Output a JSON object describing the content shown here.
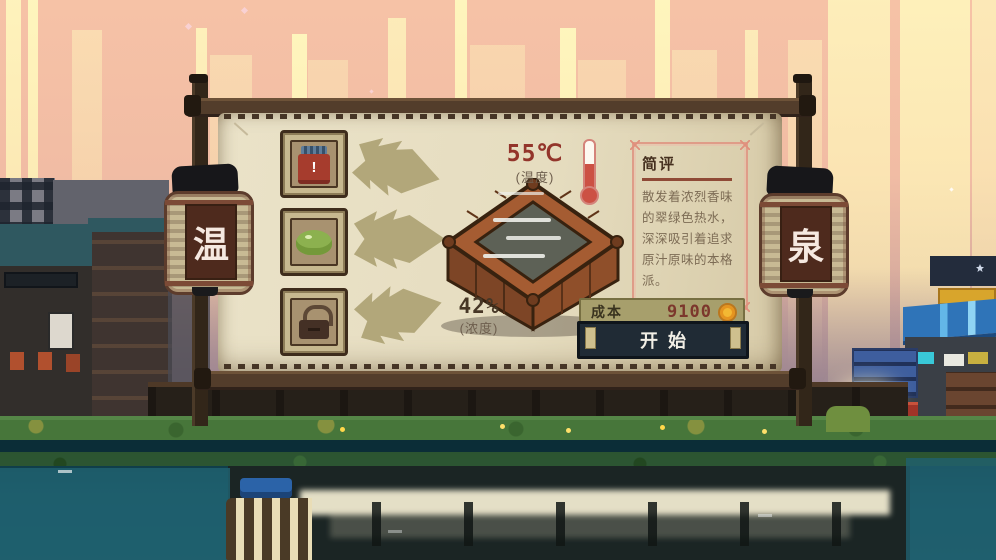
{
  "lanterns": {
    "left": "温",
    "right": "泉"
  },
  "slots": [
    {
      "name": "red-jar",
      "icon": "jar-icon",
      "badge": "!"
    },
    {
      "name": "green-herb",
      "icon": "herb-icon"
    },
    {
      "name": "locked-slot",
      "icon": "lock-icon"
    }
  ],
  "stats": {
    "temperature": {
      "value": "55℃",
      "caption": "(温度)",
      "icon": "thermometer-icon"
    },
    "concentration": {
      "value": "42%",
      "caption": "(浓度)"
    }
  },
  "review": {
    "title": "简评",
    "body": "散发着浓烈香味的翠绿色热水，深深吸引着追求原汁原味的本格派。"
  },
  "cost": {
    "label": "成本",
    "amount": "9100",
    "currency_icon": "coin-icon"
  },
  "actions": {
    "start": "开始"
  },
  "colors": {
    "accent_red": "#93352b",
    "parchment": "#e7dfc4",
    "arrow_olive": "#b2a77a",
    "button_dark": "#202b35",
    "coin_gold": "#f3b833",
    "review_border": "#df9c88"
  }
}
